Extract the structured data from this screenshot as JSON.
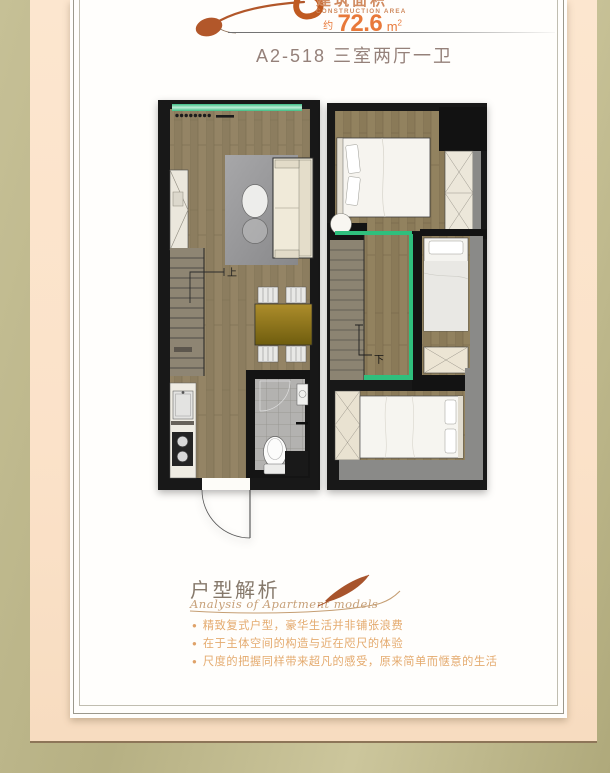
{
  "header": {
    "area_label_cn": "建筑面积",
    "area_label_en": "CONSTRUCTION AREA",
    "area_prefix": "约",
    "area_value": "72.6",
    "area_unit_base": "m",
    "area_unit_sup": "2",
    "unit_code_line": "A2-518  三室两厅一卫"
  },
  "floorplan": {
    "lower_level": {
      "stair_label_up": "上"
    },
    "upper_level": {
      "stair_label_down": "下"
    }
  },
  "analysis": {
    "title": "户型解析",
    "subtitle": "Analysis of Apartment models",
    "bullets": [
      "精致复式户型，豪华生活并非铺张浪费",
      "在于主体空间的构造与近在咫尺的体验",
      "尺度的把握同样带来超凡的感受，原来简单而惬意的生活"
    ],
    "bullet_glyph": "●"
  },
  "colors": {
    "accent_orange": "#e8793a",
    "title_brown": "#95817a",
    "bullet_orange": "#e4aa6e",
    "green_accent": "#2fbf7d",
    "frame_olive": "#bdb789",
    "frame_peach": "#fbe3cb"
  }
}
